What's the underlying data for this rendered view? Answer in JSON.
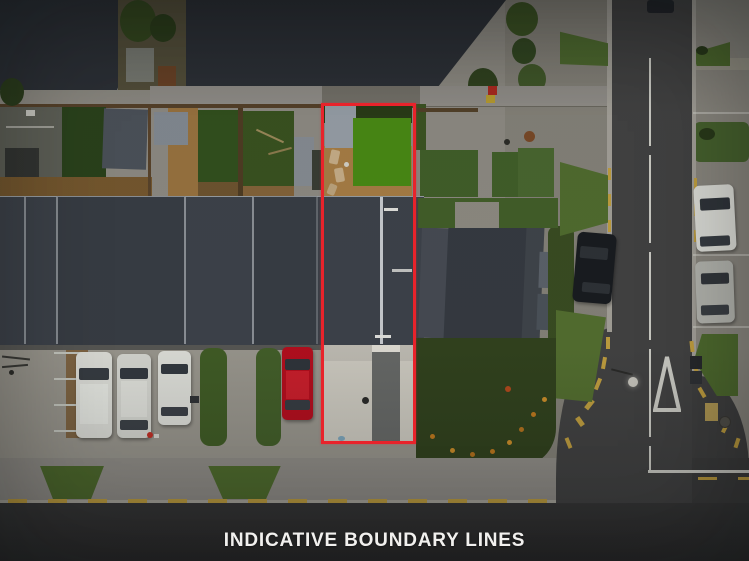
{
  "caption": {
    "text": "INDICATIVE BOUNDARY LINES"
  },
  "colors": {
    "boundary-red": "#e8232b",
    "caption-white": "#f1f0ee",
    "asphalt-road": "#434343",
    "asphalt-road-dark": "#383838",
    "concrete-pavement": "#8f8c84",
    "concrete-bright": "#cfccc2",
    "roof-dark": "#2d3137",
    "roof-row-grey": "#3e434b",
    "lawn-bright-green": "#4a8c15",
    "lawn-dark-green": "#33511e",
    "deck-wood": "#a97f46",
    "garden-green": "#32431e",
    "verge-green": "#4f6b2d",
    "marking-yellow": "#c2a040",
    "marking-white": "#cfcfc8",
    "car-red": "#b60f1e",
    "car-white": "#dfe0da",
    "car-silver": "#b5b6b0",
    "car-black": "#191c20"
  }
}
